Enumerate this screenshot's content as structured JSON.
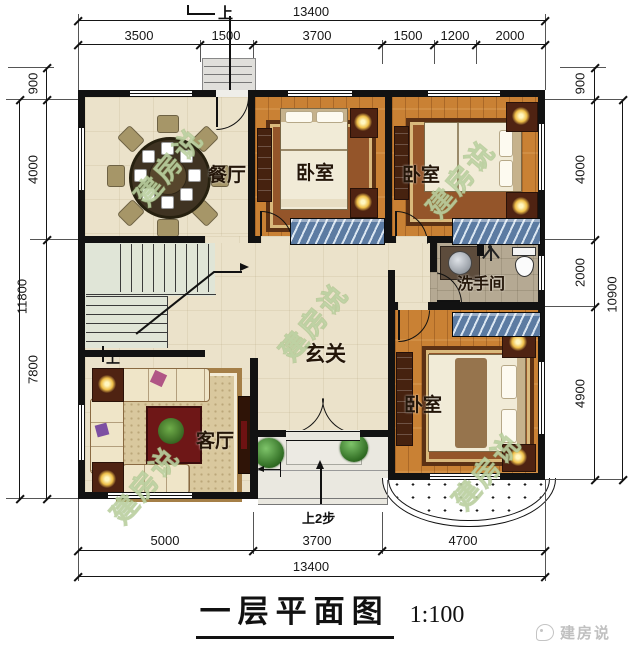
{
  "title": {
    "text": "一层平面图",
    "scale": "1:100"
  },
  "watermark": {
    "text": "建房说"
  },
  "logo": {
    "text": "建房说"
  },
  "rooms": {
    "dining": "餐厅",
    "bedroom_top_left": "卧室",
    "bedroom_top_right": "卧室",
    "bathroom": "洗手间",
    "hall": "玄关",
    "living": "客厅",
    "bedroom_bottom": "卧室"
  },
  "annotations": {
    "up_back": "上",
    "up_stairs": "上",
    "entry_steps": "上2步"
  },
  "dims": {
    "top": {
      "total": "13400",
      "segments": [
        "3500",
        "1500",
        "3700",
        "1500",
        "1200",
        "2000"
      ]
    },
    "bottom": {
      "total": "13400",
      "segments": [
        "5000",
        "3700",
        "4700"
      ]
    },
    "left": {
      "total": "11800",
      "segments": [
        "900",
        "4000",
        "7800"
      ]
    },
    "right": {
      "total": "10900",
      "segments": [
        "900",
        "4000",
        "2000",
        "4900"
      ]
    }
  },
  "colors": {
    "wall": "#121212",
    "floor_tile": "#ebe2ca",
    "floor_wood": "#c98134",
    "floor_bath": "#b5a993",
    "floor_stairs": "#e0e5d7",
    "window_bay": "#5c7ba2",
    "lamp_glow": "#efc04a",
    "watermark": "#e4f0d2"
  }
}
